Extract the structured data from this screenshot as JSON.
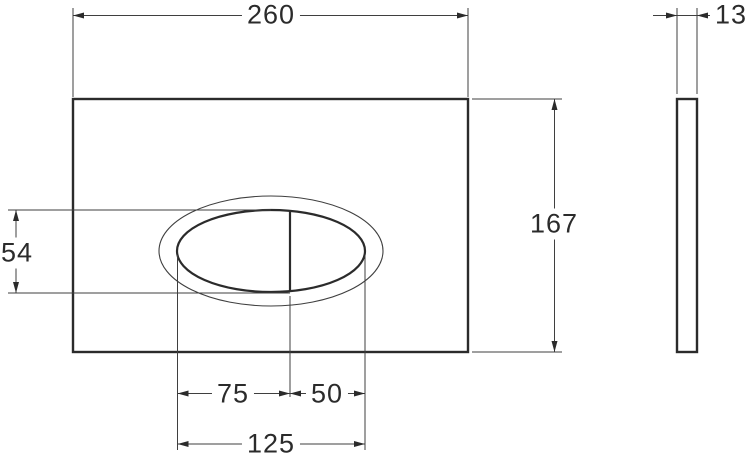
{
  "colors": {
    "background": "#ffffff",
    "outline": "#2b2b2b",
    "dimension_lines": "#3f3f3f"
  },
  "dimensions": {
    "plate_width": "260",
    "plate_height": "167",
    "plate_thickness": "13",
    "button_height": "54",
    "button_left_segment": "75",
    "button_right_segment": "50",
    "button_total_width": "125"
  }
}
